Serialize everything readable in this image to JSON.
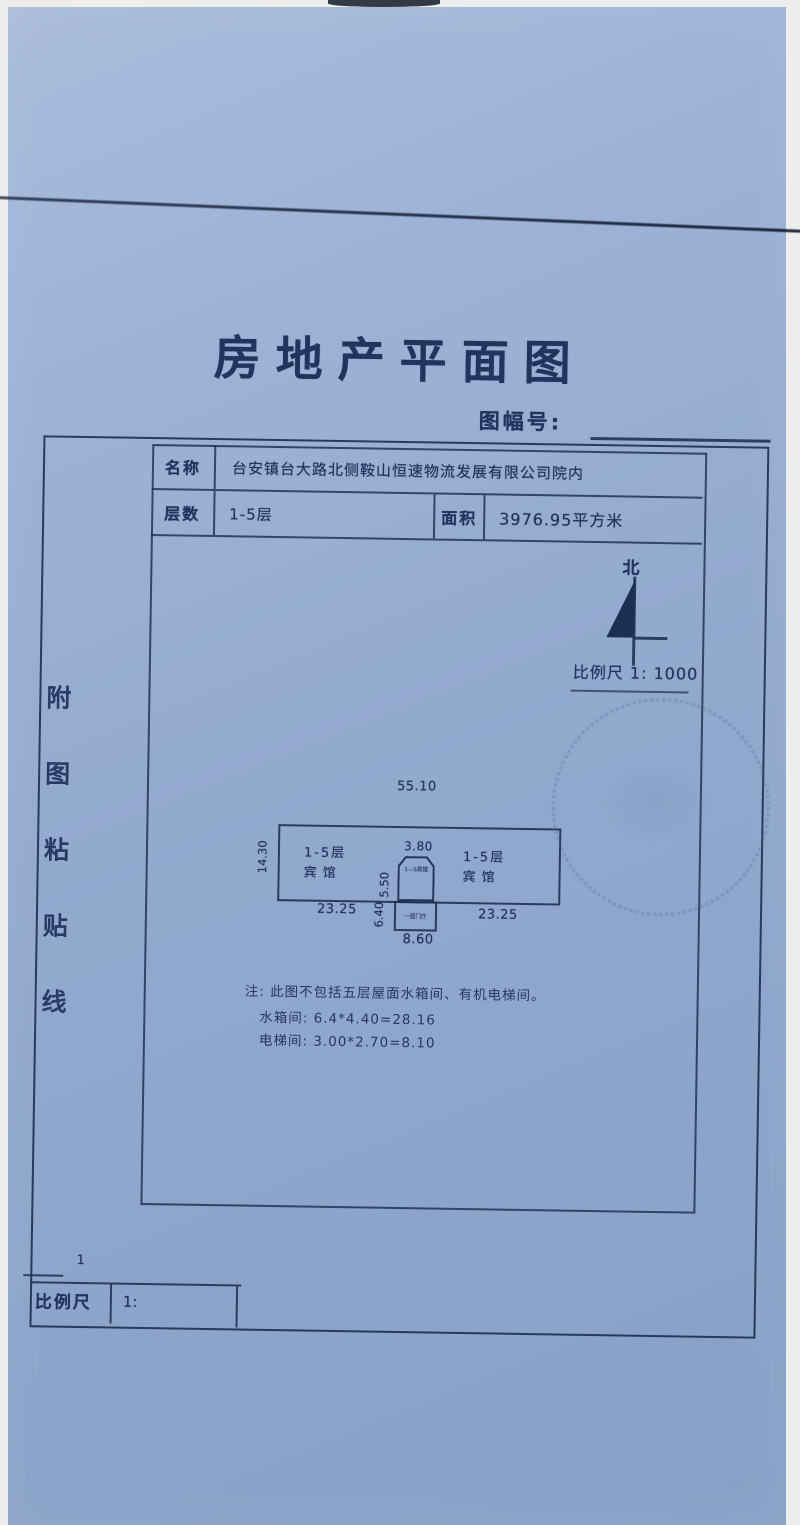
{
  "document": {
    "title": "房地产平面图",
    "sheet_no_label": "图幅号:",
    "info_table": {
      "name_label": "名称",
      "name_value": "台安镇台大路北侧鞍山恒速物流发展有限公司院内",
      "floors_label": "层数",
      "floors_value": "1-5层",
      "area_label": "面积",
      "area_value": "3976.95平方米"
    },
    "compass": {
      "north_label": "北",
      "scale_text": "比例尺 1: 1000"
    },
    "plan": {
      "dim_top": "55.10",
      "dim_left": "14.30",
      "dim_entry_width": "3.80",
      "dim_entry_depth": "5.50",
      "dim_porch_depth": "6.40",
      "dim_porch_width": "8.60",
      "dim_bottom_left": "23.25",
      "dim_bottom_right": "23.25",
      "room_left_line1": "1-5层",
      "room_left_line2": "宾馆",
      "room_right_line1": "1-5层",
      "room_right_line2": "宾馆",
      "entry_label": "1—5宾馆",
      "porch_label": "一层门厅"
    },
    "notes": {
      "line1": "注: 此图不包括五层屋面水箱间、有机电梯间。",
      "line2": "水箱间: 6.4*4.40=28.16",
      "line3": "电梯间: 3.00*2.70=8.10"
    },
    "paste_line": [
      "附",
      "图",
      "粘",
      "贴",
      "线"
    ],
    "footer": {
      "page_mark": "1",
      "scale_label": "比例尺",
      "scale_prefix": "1:"
    },
    "colors": {
      "paper_blue": "#93aacf",
      "ink": "#22335c",
      "stamp": "#52668e"
    }
  }
}
